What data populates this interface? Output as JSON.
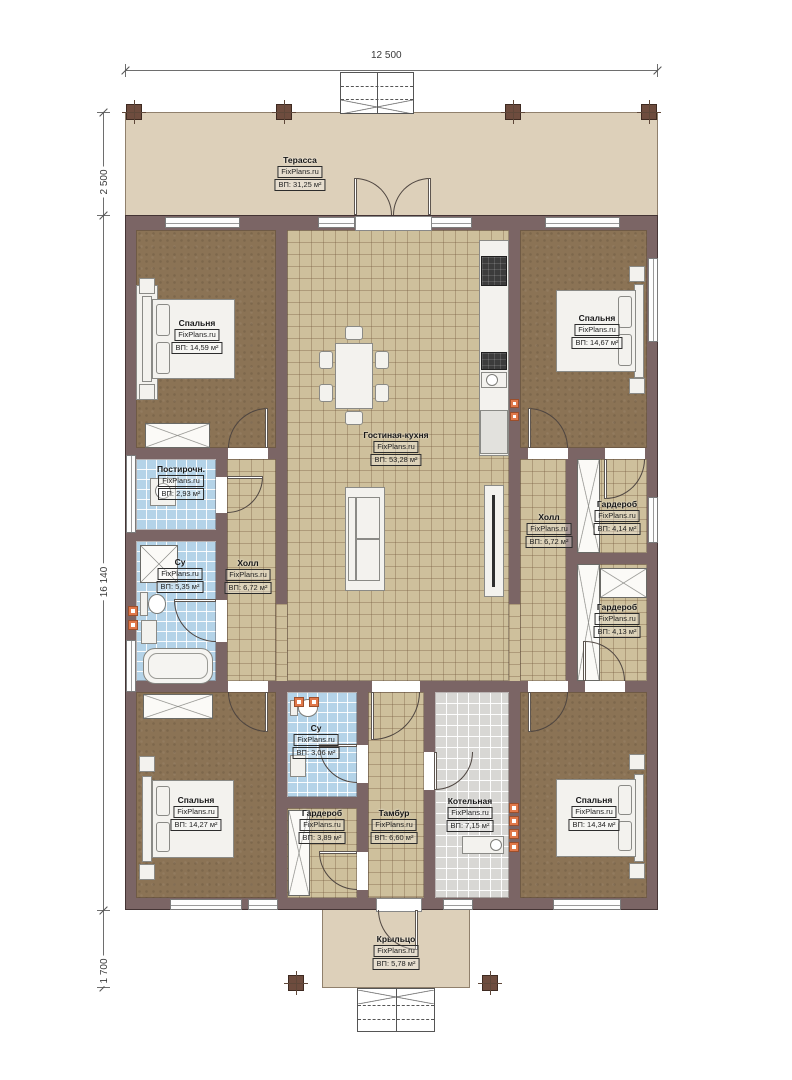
{
  "watermark": "FixPlans.ru",
  "dimensions": {
    "top_width": "12 500",
    "terrace_depth": "2 500",
    "house_depth": "16 140",
    "porch_depth": "1 700"
  },
  "rooms": {
    "terrace": {
      "name": "Терасса",
      "area": "ВП: 31,25 м²"
    },
    "bedroom_top_left": {
      "name": "Спальня",
      "area": "ВП: 14,59 м²"
    },
    "living_kitchen": {
      "name": "Гостиная-кухня",
      "area": "ВП: 53,28 м²"
    },
    "bedroom_top_right": {
      "name": "Спальня",
      "area": "ВП: 14,67 м²"
    },
    "laundry": {
      "name": "Постирочн.",
      "area": "ВП: 2,93 м²"
    },
    "bathroom_left": {
      "name": "Су",
      "area": "ВП: 5,35 м²"
    },
    "hall_left": {
      "name": "Холл",
      "area": "ВП: 6,72 м²"
    },
    "hall_right": {
      "name": "Холл",
      "area": "ВП: 6,72 м²"
    },
    "wardrobe_right_top": {
      "name": "Гардероб",
      "area": "ВП: 4,14 м²"
    },
    "wardrobe_right_bottom": {
      "name": "Гардероб",
      "area": "ВП: 4,13 м²"
    },
    "bedroom_bottom_left": {
      "name": "Спальня",
      "area": "ВП: 14,27 м²"
    },
    "bathroom_bottom": {
      "name": "Су",
      "area": "ВП: 3,06 м²"
    },
    "wardrobe_bottom": {
      "name": "Гардероб",
      "area": "ВП: 3,89 м²"
    },
    "vestibule": {
      "name": "Тамбур",
      "area": "ВП: 6,60 м²"
    },
    "boiler_room": {
      "name": "Котельная",
      "area": "ВП: 7,15 м²"
    },
    "bedroom_bottom_right": {
      "name": "Спальня",
      "area": "ВП: 14,34 м²"
    },
    "porch": {
      "name": "Крыльцо",
      "area": "ВП: 5,78 м²"
    }
  },
  "colors": {
    "wall": "#7b6565",
    "terrace_floor": "#ddd0ba",
    "tile_tan": "#cec09c",
    "tile_blue": "#b4d3e8",
    "tile_gray": "#d8d7d4",
    "bedroom_floor": "#8b7355",
    "radiator": "#e0784a"
  }
}
